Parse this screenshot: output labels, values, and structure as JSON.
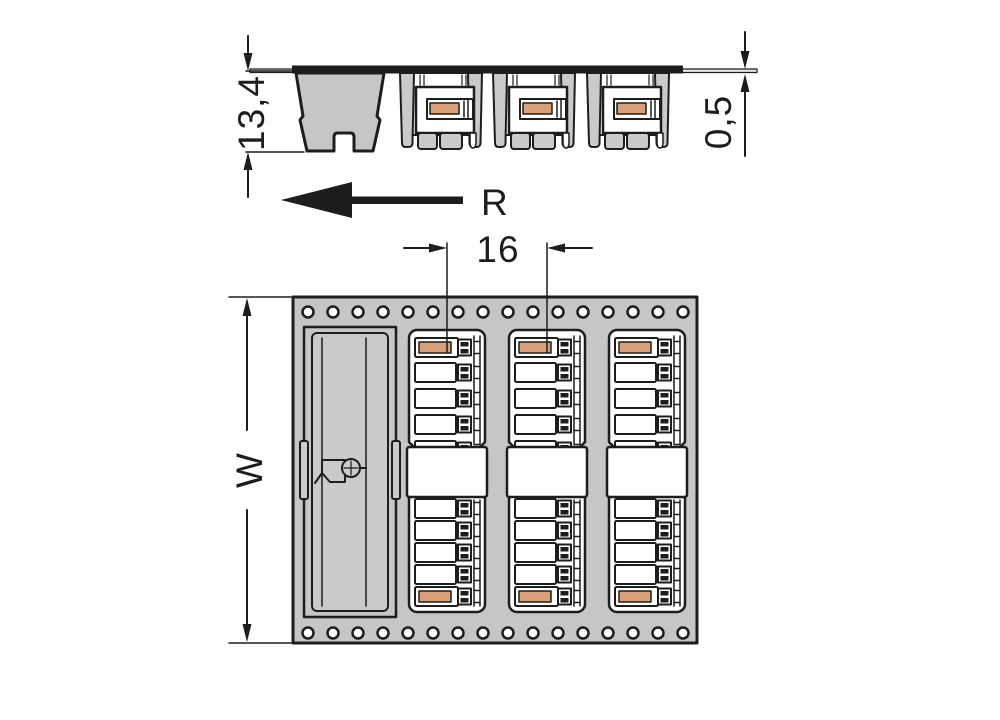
{
  "side_view": {
    "height_dim": "13,4",
    "tape_thickness_dim": "0,5",
    "direction_label": "R",
    "connector_count": 3
  },
  "top_view": {
    "pitch_dim": "16",
    "width_dim": "W",
    "connector_count": 3,
    "sprocket_holes_per_row": 16
  },
  "colors": {
    "outline": "#1d1d1b",
    "tape_gray": "#c6c6c6",
    "pocket_gray": "#cacaca",
    "accent_orange": "#d9a078",
    "tape_strip": "#e8e8e8",
    "background": "#ffffff"
  }
}
